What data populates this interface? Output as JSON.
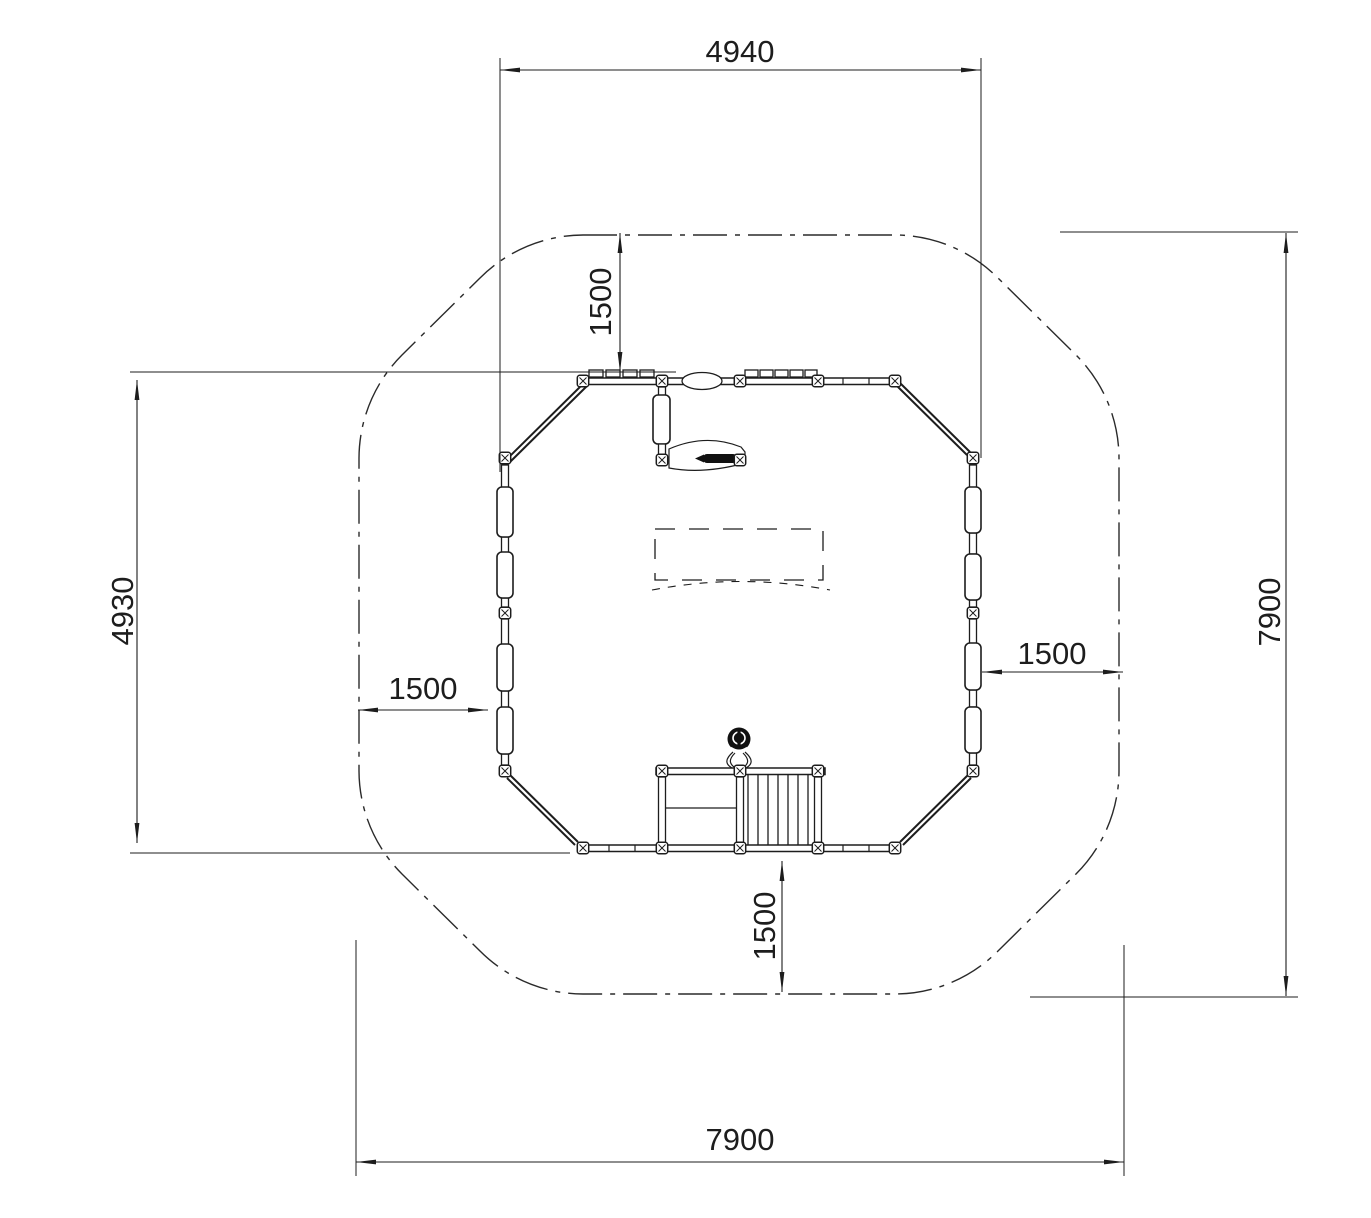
{
  "drawing": {
    "units": "mm",
    "colors": {
      "line": "#1d1d1d",
      "background": "#ffffff"
    },
    "dimensions": {
      "overall_width": "4940",
      "overall_depth": "4930",
      "safety_zone_width": "7900",
      "safety_zone_depth": "7900",
      "clearance_top": "1500",
      "clearance_left": "1500",
      "clearance_right": "1500",
      "clearance_bottom": "1500"
    },
    "icons": {
      "steering_wheel": "steering-wheel-icon",
      "posts": "post-icon",
      "stairs": "stairs"
    }
  }
}
